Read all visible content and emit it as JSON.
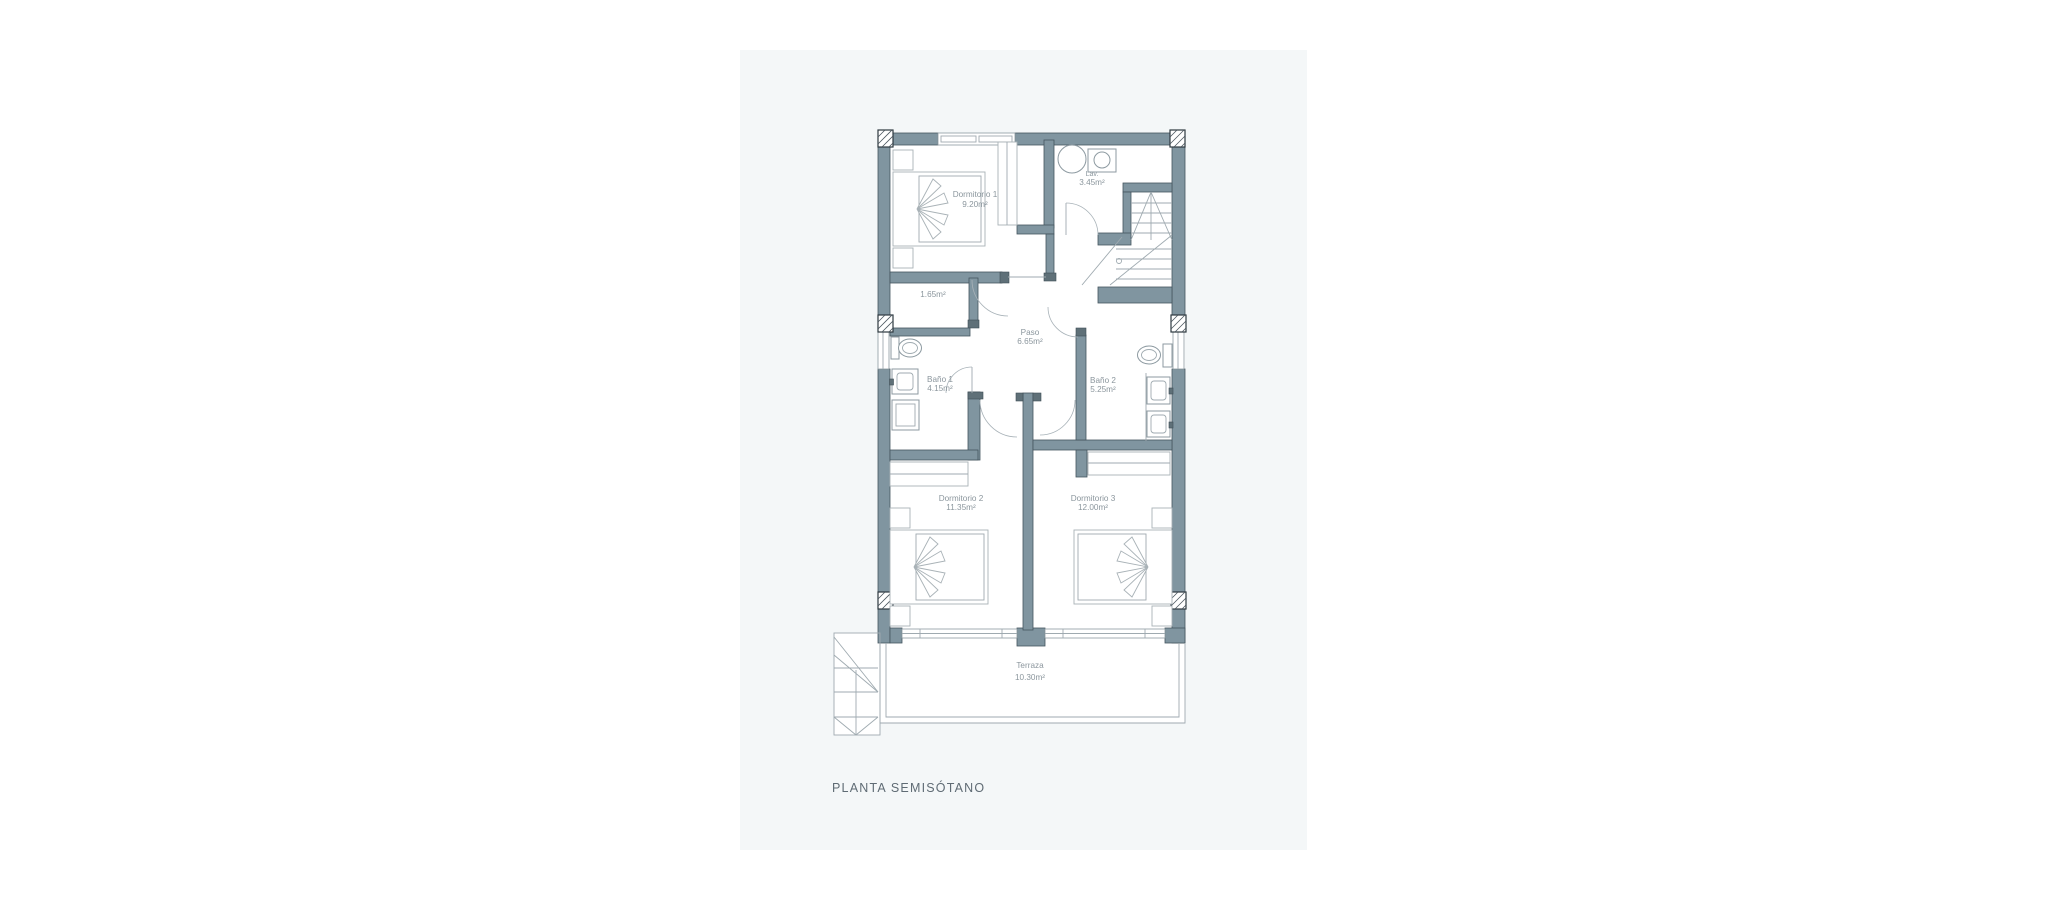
{
  "caption": {
    "text": "PLANTA SEMISÓTANO"
  },
  "rooms": [
    {
      "id": "dormitorio-1",
      "name": "Dormitorio 1",
      "area": "9.20m²"
    },
    {
      "id": "lavadero",
      "name": "Lav.",
      "area": "3.45m²"
    },
    {
      "id": "armario",
      "name": "",
      "area": "1.65m²"
    },
    {
      "id": "paso",
      "name": "Paso",
      "area": "6.65m²"
    },
    {
      "id": "bano-1",
      "name": "Baño 1",
      "area": "4.15m²"
    },
    {
      "id": "bano-2",
      "name": "Baño 2",
      "area": "5.25m²"
    },
    {
      "id": "dormitorio-2",
      "name": "Dormitorio 2",
      "area": "11.35m²"
    },
    {
      "id": "dormitorio-3",
      "name": "Dormitorio 3",
      "area": "12.00m²"
    },
    {
      "id": "terraza",
      "name": "Terraza",
      "area": "10.30m²"
    }
  ],
  "colors": {
    "page_bg": "#ffffff",
    "panel_bg": "#f4f7f8",
    "wall": "#8095a0",
    "wall_stroke": "#45555f",
    "line": "#9faab0",
    "label_text": "#8b969d",
    "caption_text": "#5f6b74",
    "pillar_stroke": "#2d383f"
  }
}
